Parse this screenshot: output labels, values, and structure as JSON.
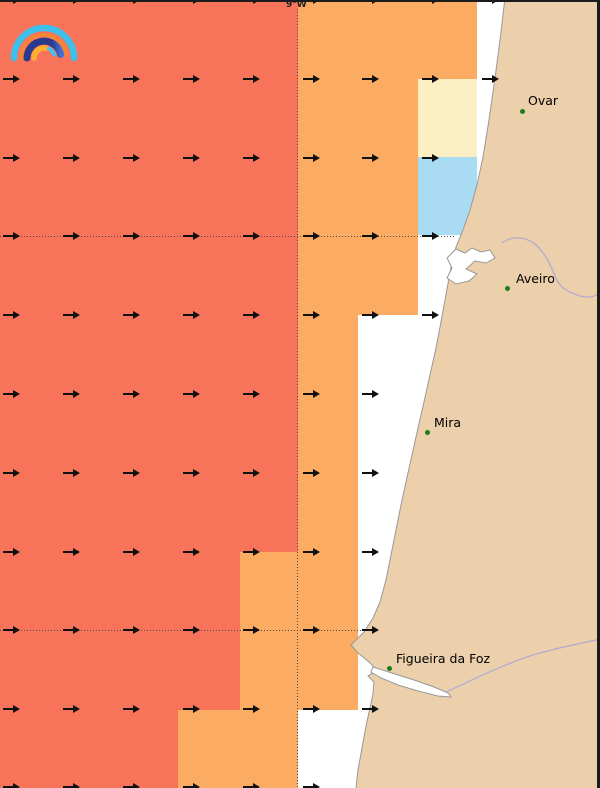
{
  "map": {
    "width": 600,
    "height": 788,
    "meridian_label": "9°W",
    "colors": {
      "salmon": "#F7745A",
      "orange": "#FBAC62",
      "cream": "#FCEFC4",
      "lightblue": "#A9DCF3",
      "land": "#ECCFAB",
      "water_nodata": "#FFFFFF",
      "coast": "#999999",
      "river": "#B3ACCF",
      "grid": "#4A4A4A",
      "arrow": "#111111",
      "city_dot": "#1B7E1B",
      "frame": "#1B1B1B",
      "label_text": "#000000"
    },
    "cells": [
      {
        "x": 0,
        "y": 0,
        "w": 298,
        "h": 552,
        "color": "salmon"
      },
      {
        "x": 0,
        "y": 552,
        "w": 240,
        "h": 158,
        "color": "salmon"
      },
      {
        "x": 0,
        "y": 710,
        "w": 178,
        "h": 78,
        "color": "salmon"
      },
      {
        "x": 298,
        "y": 0,
        "w": 179,
        "h": 79,
        "color": "orange"
      },
      {
        "x": 298,
        "y": 79,
        "w": 120,
        "h": 236,
        "color": "orange"
      },
      {
        "x": 298,
        "y": 315,
        "w": 60,
        "h": 237,
        "color": "orange"
      },
      {
        "x": 240,
        "y": 552,
        "w": 118,
        "h": 158,
        "color": "orange"
      },
      {
        "x": 178,
        "y": 710,
        "w": 120,
        "h": 78,
        "color": "orange"
      },
      {
        "x": 418,
        "y": 79,
        "w": 59,
        "h": 78,
        "color": "cream"
      },
      {
        "x": 418,
        "y": 157,
        "w": 59,
        "h": 78,
        "color": "lightblue"
      }
    ],
    "grid": {
      "vertical": {
        "x": 297,
        "y1": 9,
        "y2": 788
      },
      "horizontal": [
        {
          "y": 236,
          "x1": 0,
          "x2": 456
        },
        {
          "y": 630,
          "x1": 0,
          "x2": 364
        }
      ]
    },
    "arrows": {
      "direction": "east",
      "tail_x": [
        3,
        63,
        123,
        183,
        243,
        303,
        362,
        422,
        482
      ],
      "rows": [
        {
          "y": 0,
          "count": 9
        },
        {
          "y": 79,
          "count": 9
        },
        {
          "y": 158,
          "count": 8
        },
        {
          "y": 236,
          "count": 8
        },
        {
          "y": 315,
          "count": 8
        },
        {
          "y": 394,
          "count": 7
        },
        {
          "y": 473,
          "count": 7
        },
        {
          "y": 552,
          "count": 7
        },
        {
          "y": 630,
          "count": 7
        },
        {
          "y": 709,
          "count": 7
        },
        {
          "y": 787,
          "count": 6
        }
      ]
    },
    "cities": [
      {
        "name": "Ovar",
        "dot_x": 522,
        "dot_y": 111,
        "label_x": 528,
        "label_y": 93
      },
      {
        "name": "Aveiro",
        "dot_x": 507,
        "dot_y": 288,
        "label_x": 516,
        "label_y": 271
      },
      {
        "name": "Mira",
        "dot_x": 427,
        "dot_y": 432,
        "label_x": 434,
        "label_y": 415
      },
      {
        "name": "Figueira da Foz",
        "dot_x": 389,
        "dot_y": 668,
        "label_x": 396,
        "label_y": 651
      }
    ],
    "shapes": [
      {
        "name": "land-portugal-coast",
        "fill": "land",
        "stroke": "coast",
        "sw": 1,
        "d": "M 505,-2 L 602,-2 L 602,790 L 355,790 L 356,788 L 358,770 L 362,748 L 366,726 L 370,708 L 373,694 L 374,682 L 368,676 L 377,670 L 369,662 L 358,653 L 351,645 L 364,632 L 373,618 L 380,602 L 386,580 L 391,555 L 396,530 L 401,505 L 406,482 L 412,455 L 418,428 L 424,402 L 430,375 L 436,348 L 441,322 L 445,300 L 449,278 L 452,262 L 456,247 L 463,230 L 470,210 L 477,185 L 483,157 L 489,120 L 495,78 L 500,40 Z"
      },
      {
        "name": "aveiro-lagoon",
        "fill": "water_nodata",
        "stroke": "coast",
        "sw": 1,
        "d": "M 447,258 L 456,249 L 465,253 L 472,248 L 481,252 L 490,250 L 495,258 L 486,263 L 475,261 L 466,269 L 477,274 L 469,281 L 456,284 L 447,278 L 452,268 Z"
      },
      {
        "name": "mondego-estuary",
        "fill": "water_nodata",
        "stroke": "coast",
        "sw": 1,
        "d": "M 373,667 L 392,673 L 414,680 L 434,687 L 448,693 L 451,697 L 438,696 L 418,691 L 398,685 L 381,678 L 371,672 Z"
      },
      {
        "name": "river-near-aveiro",
        "fill": "none",
        "stroke": "river",
        "sw": 1.3,
        "d": "M 502,243 C 512,236 524,236 535,244 C 546,254 551,266 556,278 C 560,288 568,292 580,296 C 588,298 594,297 598,294"
      },
      {
        "name": "river-mondego",
        "fill": "none",
        "stroke": "river",
        "sw": 1.3,
        "d": "M 446,692 C 468,682 492,670 516,661 C 536,653 558,648 601,639"
      }
    ],
    "icons": [
      {
        "name": "rainbow-logo-icon"
      },
      {
        "name": "wind-arrow-icon"
      }
    ]
  }
}
